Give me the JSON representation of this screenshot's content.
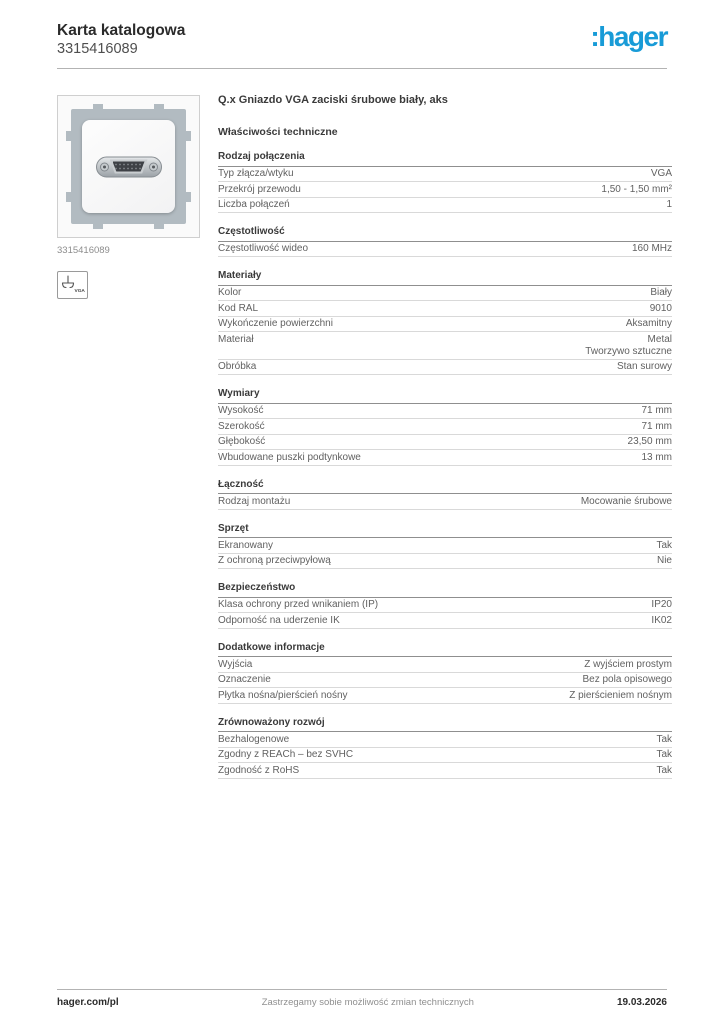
{
  "header": {
    "doc_type": "Karta katalogowa",
    "product_number": "3315416089",
    "brand": ":hager",
    "brand_color": "#189bd7"
  },
  "product": {
    "image_caption": "3315416089",
    "symbol_label": "VGA"
  },
  "main": {
    "title": "Q.x Gniazdo VGA zaciski śrubowe biały, aks",
    "subtitle": "Właściwości techniczne",
    "sections": [
      {
        "heading": "Rodzaj połączenia",
        "rows": [
          {
            "label": "Typ złącza/wtyku",
            "value": "VGA"
          },
          {
            "label": "Przekrój przewodu",
            "value": "1,50 - 1,50 mm²"
          },
          {
            "label": "Liczba połączeń",
            "value": "1"
          }
        ]
      },
      {
        "heading": "Częstotliwość",
        "rows": [
          {
            "label": "Częstotliwość wideo",
            "value": "160 MHz"
          }
        ]
      },
      {
        "heading": "Materiały",
        "rows": [
          {
            "label": "Kolor",
            "value": "Biały"
          },
          {
            "label": "Kod RAL",
            "value": "9010"
          },
          {
            "label": "Wykończenie powierzchni",
            "value": "Aksamitny"
          },
          {
            "label": "Materiał",
            "value": [
              "Metal",
              "Tworzywo sztuczne"
            ]
          },
          {
            "label": "Obróbka",
            "value": "Stan surowy"
          }
        ]
      },
      {
        "heading": "Wymiary",
        "rows": [
          {
            "label": "Wysokość",
            "value": "71 mm"
          },
          {
            "label": "Szerokość",
            "value": "71 mm"
          },
          {
            "label": "Głębokość",
            "value": "23,50 mm"
          },
          {
            "label": "Wbudowane puszki podtynkowe",
            "value": "13 mm"
          }
        ]
      },
      {
        "heading": "Łączność",
        "rows": [
          {
            "label": "Rodzaj montażu",
            "value": "Mocowanie śrubowe"
          }
        ]
      },
      {
        "heading": "Sprzęt",
        "rows": [
          {
            "label": "Ekranowany",
            "value": "Tak"
          },
          {
            "label": "Z ochroną przeciwpyłową",
            "value": "Nie"
          }
        ]
      },
      {
        "heading": "Bezpieczeństwo",
        "rows": [
          {
            "label": "Klasa ochrony przed wnikaniem (IP)",
            "value": "IP20"
          },
          {
            "label": "Odporność na uderzenie IK",
            "value": "IK02"
          }
        ]
      },
      {
        "heading": "Dodatkowe informacje",
        "rows": [
          {
            "label": "Wyjścia",
            "value": "Z wyjściem prostym"
          },
          {
            "label": "Oznaczenie",
            "value": "Bez pola opisowego"
          },
          {
            "label": "Płytka nośna/pierścień nośny",
            "value": "Z pierścieniem nośnym"
          }
        ]
      },
      {
        "heading": "Zrównoważony rozwój",
        "rows": [
          {
            "label": "Bezhalogenowe",
            "value": "Tak"
          },
          {
            "label": "Zgodny z REACh – bez SVHC",
            "value": "Tak"
          },
          {
            "label": "Zgodność z RoHS",
            "value": "Tak"
          }
        ]
      }
    ]
  },
  "footer": {
    "website": "hager.com/pl",
    "disclaimer": "Zastrzegamy sobie możliwość zmian technicznych",
    "date": "19.03.2026"
  }
}
